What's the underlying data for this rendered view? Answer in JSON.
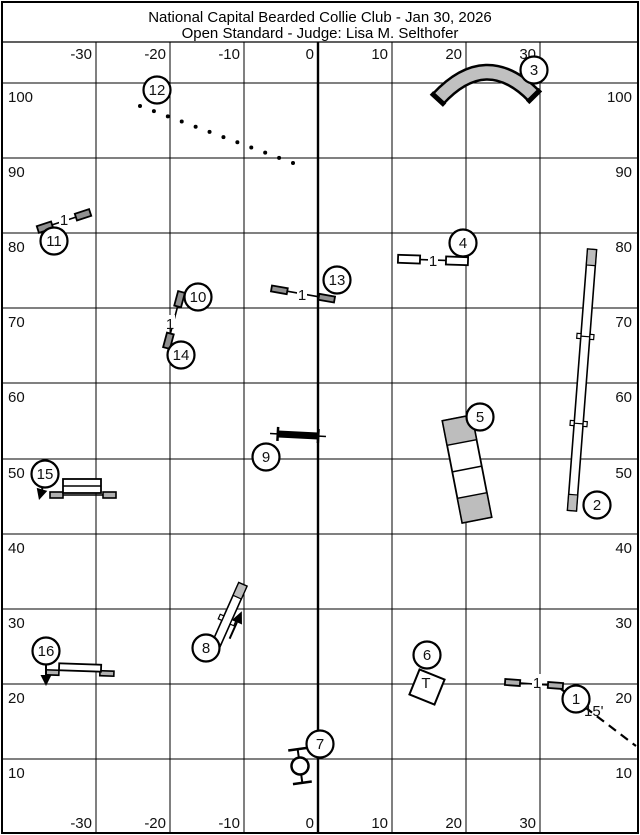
{
  "title": {
    "line1": "National Capital Bearded Collie Club - Jan 30, 2026",
    "line2": "Open Standard - Judge: Lisa M. Selthofer"
  },
  "colors": {
    "blue": "#4356b8",
    "tunnel_gray": "#c0c0c0",
    "wing_gray": "#b0b0b0",
    "contact_gray": "#bdbdbd",
    "line": "#000000"
  },
  "grid": {
    "border": [
      2,
      2,
      636,
      831
    ],
    "title_sep_y": 42,
    "x_lines": [
      96,
      170,
      244,
      318,
      392,
      466,
      540
    ],
    "thick_x": 318,
    "y_lines": [
      83,
      158,
      233,
      308,
      383,
      459,
      534,
      609,
      684,
      759
    ],
    "x_labels": [
      "-30",
      "-20",
      "-10",
      "0",
      "10",
      "20",
      "30"
    ],
    "y_labels": [
      "100",
      "90",
      "80",
      "70",
      "60",
      "50",
      "40",
      "30",
      "20",
      "10"
    ]
  },
  "obstacles": [
    {
      "id": "jump-1",
      "kind": "jump",
      "cx": 534,
      "cy": 684,
      "len": 58,
      "angle": 4,
      "wing_w": 15,
      "wing_h": 6,
      "wing_fill": "#b0b0b0",
      "label": "1",
      "lx": 537,
      "ly": 683
    },
    {
      "id": "dogwalk-2",
      "kind": "dogwalk",
      "cx": 582,
      "cy": 380,
      "len": 262,
      "w": 9,
      "angle": 4.4,
      "contact": 16
    },
    {
      "id": "tunnel-3",
      "kind": "tunnel",
      "path": "M438,99 Q486,47 534,96",
      "w": 12,
      "outline": 17,
      "caps": [
        [
          431.4,
          92.9,
          444.6,
          105.1
        ],
        [
          540.4,
          89.7,
          527.6,
          102.3
        ]
      ]
    },
    {
      "id": "jump-4",
      "kind": "jump",
      "cx": 433,
      "cy": 260,
      "len": 70,
      "angle": 2,
      "wing_w": 22,
      "wing_h": 8,
      "wing_fill": "#ffffff",
      "label": "1",
      "lx": 433,
      "ly": 261
    },
    {
      "id": "aframe-5",
      "kind": "aframe",
      "cx": 467,
      "cy": 469,
      "len": 104,
      "w": 30,
      "angle": -11,
      "contact": 25
    },
    {
      "id": "table-6",
      "kind": "table",
      "cx": 427,
      "cy": 687,
      "size": 27,
      "angle": 22,
      "label": "T",
      "lx": 426,
      "ly": 688
    },
    {
      "id": "tire-7",
      "kind": "tire",
      "cx": 300,
      "cy": 766,
      "r": 8.5,
      "angle": -8,
      "half": 17,
      "bar": 9.5
    },
    {
      "id": "teeter-8",
      "kind": "teeter",
      "cx": 227,
      "cy": 620,
      "len": 78,
      "w": 9,
      "angle": 24,
      "contact": 14
    },
    {
      "id": "wall-9",
      "kind": "wall",
      "cx": 298,
      "cy": 435,
      "len": 40,
      "h": 7,
      "angle": 3,
      "cap_h": 14,
      "ext": 8
    },
    {
      "id": "jump-10-14",
      "kind": "jump",
      "cx": 174,
      "cy": 320,
      "len": 58,
      "angle": 105,
      "wing_w": 15,
      "wing_h": 7,
      "wing_fill": "#909090",
      "label": "1",
      "lx": 170,
      "ly": 324
    },
    {
      "id": "jump-11",
      "kind": "jump",
      "cx": 64,
      "cy": 221,
      "len": 55,
      "angle": -18,
      "wing_w": 15,
      "wing_h": 7,
      "wing_fill": "#909090",
      "label": "1",
      "lx": 64,
      "ly": 220
    },
    {
      "id": "weaves-12",
      "kind": "weaves",
      "x1": 140,
      "y1": 106,
      "x2": 293,
      "y2": 163,
      "count": 12,
      "r": 2
    },
    {
      "id": "jump-13",
      "kind": "jump",
      "cx": 303,
      "cy": 294,
      "len": 64,
      "angle": 10,
      "wing_w": 16,
      "wing_h": 6,
      "wing_fill": "#909090",
      "label": "1",
      "lx": 302,
      "ly": 295
    },
    {
      "id": "spread-15",
      "kind": "spread",
      "bar": [
        50,
        495,
        116,
        495
      ],
      "wings": [
        [
          50,
          492,
          13,
          6
        ],
        [
          103,
          492,
          13,
          6
        ]
      ],
      "box": [
        63,
        479,
        38,
        14
      ],
      "divider_y": 486
    },
    {
      "id": "panel-16",
      "kind": "panel",
      "cx": 80,
      "cy": 670,
      "angle": 2,
      "panel": [
        -21,
        -6,
        42,
        7
      ],
      "wings": [
        [
          -34,
          1,
          13,
          5
        ],
        [
          20,
          0,
          14,
          5
        ]
      ]
    },
    {
      "id": "arrow-15",
      "kind": "arrow",
      "x1": 43,
      "y1": 486,
      "x2": 39,
      "y2": 500
    },
    {
      "id": "arrow-16",
      "kind": "arrow",
      "x1": 46,
      "y1": 663,
      "x2": 46,
      "y2": 686
    },
    {
      "id": "lead-line-1",
      "kind": "dashed",
      "x1": 561,
      "y1": 689,
      "x2": 636,
      "y2": 746
    }
  ],
  "badges": [
    {
      "n": "1",
      "x": 576,
      "y": 699
    },
    {
      "n": "2",
      "x": 597,
      "y": 505
    },
    {
      "n": "3",
      "x": 534,
      "y": 70
    },
    {
      "n": "4",
      "x": 463,
      "y": 243
    },
    {
      "n": "5",
      "x": 480,
      "y": 417
    },
    {
      "n": "6",
      "x": 427,
      "y": 655
    },
    {
      "n": "7",
      "x": 320,
      "y": 744
    },
    {
      "n": "8",
      "x": 206,
      "y": 648
    },
    {
      "n": "9",
      "x": 266,
      "y": 457
    },
    {
      "n": "10",
      "x": 198,
      "y": 297
    },
    {
      "n": "11",
      "x": 54,
      "y": 241
    },
    {
      "n": "12",
      "x": 157,
      "y": 90
    },
    {
      "n": "13",
      "x": 337,
      "y": 280
    },
    {
      "n": "14",
      "x": 181,
      "y": 355
    },
    {
      "n": "15",
      "x": 45,
      "y": 474
    },
    {
      "n": "16",
      "x": 46,
      "y": 651
    }
  ],
  "annotations": [
    {
      "text": "15'",
      "x": 584,
      "y": 716
    }
  ]
}
